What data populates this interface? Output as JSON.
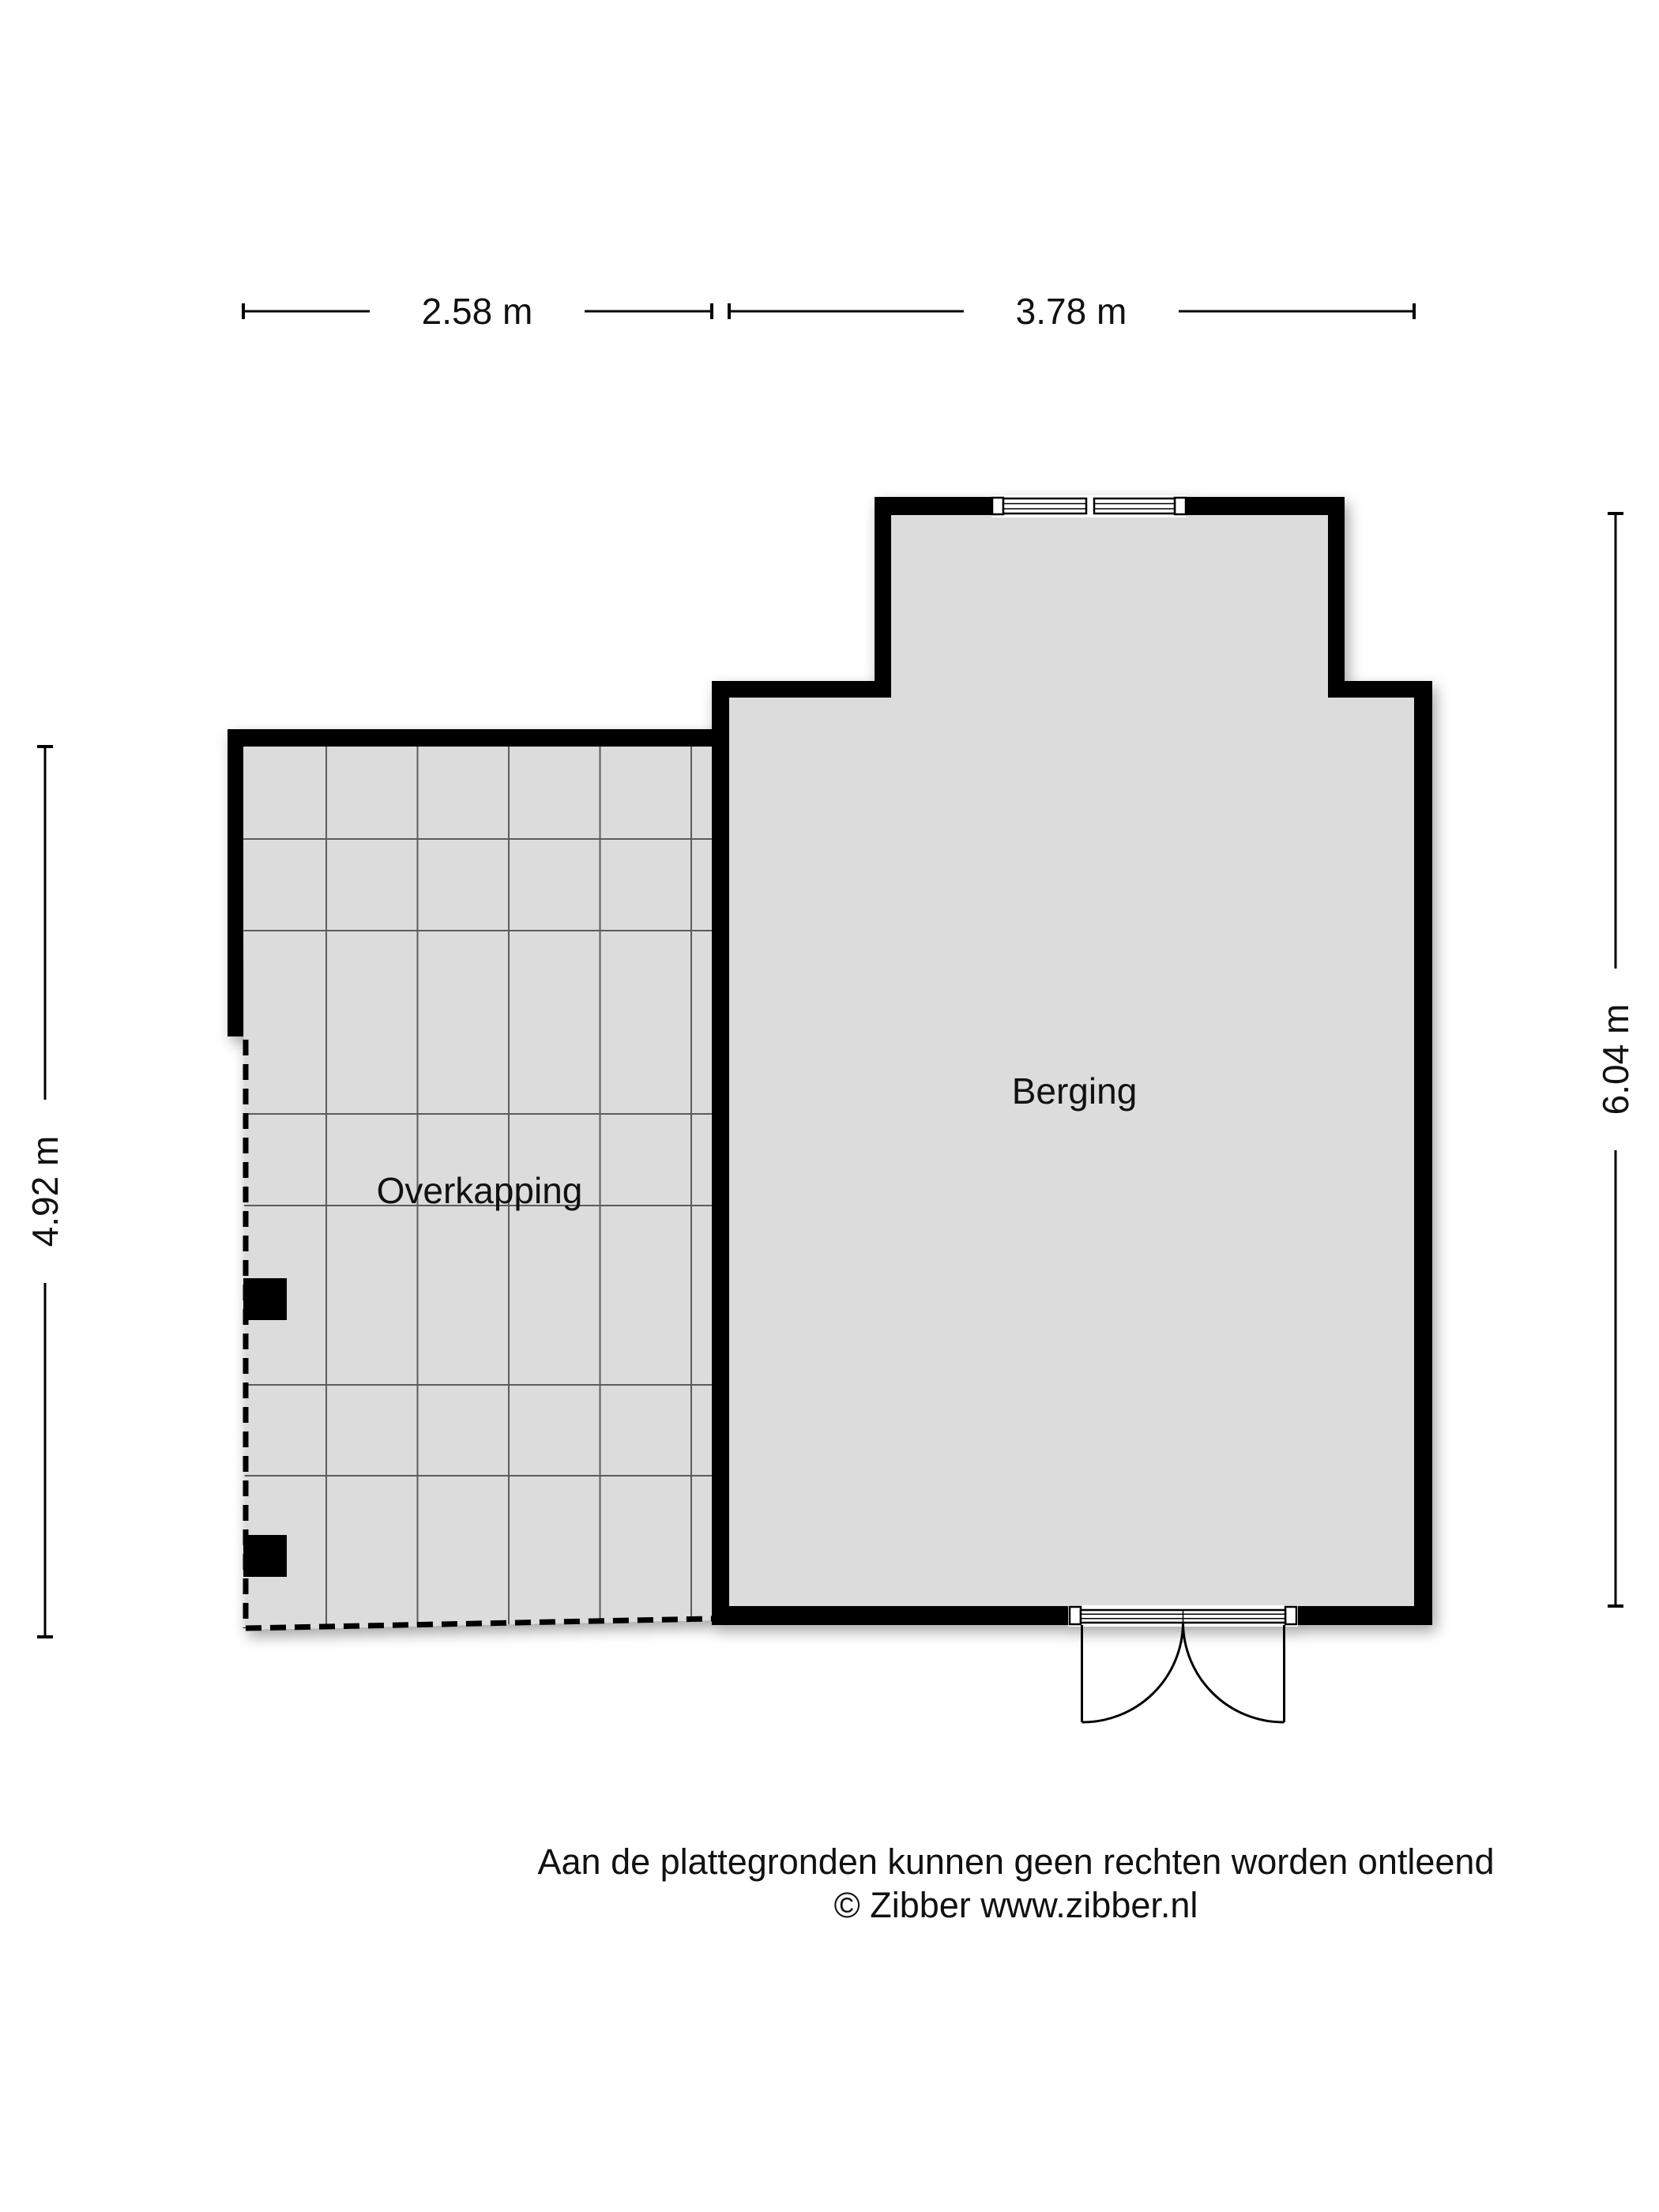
{
  "floor_plan": {
    "rooms": [
      {
        "name": "Overkapping",
        "width_label": "2.58 m",
        "depth_label": "4.92 m"
      },
      {
        "name": "Berging",
        "width_label": "3.78 m",
        "depth_label": "6.04 m"
      }
    ],
    "dimensions": {
      "top_left": "2.58 m",
      "top_right": "3.78 m",
      "left": "4.92 m",
      "right": "6.04 m"
    }
  },
  "footer": {
    "disclaimer": "Aan de plattegronden kunnen geen rechten worden ontleend",
    "credit": "© Zibber www.zibber.nl"
  },
  "colors": {
    "wall": "#000000",
    "floor": "#dcdcdc",
    "tile_grid_line": "#5c5c5c",
    "background": "#ffffff",
    "text": "#111111"
  }
}
